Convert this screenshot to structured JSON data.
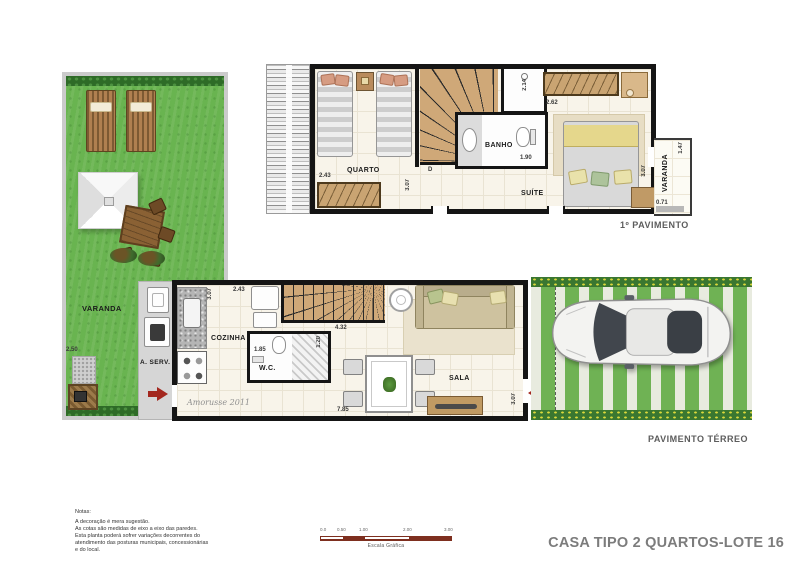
{
  "title": "CASA TIPO 2 QUARTOS-LOTE 16",
  "upper_floor": {
    "caption": "1º PAVIMENTO",
    "rooms": {
      "quarto": "QUARTO",
      "banho": "BANHO",
      "suite": "SUÍTE",
      "varanda": "VARANDA"
    },
    "dims": {
      "quarto_width": "2.43",
      "quarto_depth": "3.07",
      "shower_depth": "2.14",
      "banho_width": "1.90",
      "wardrobe_width": "2.62",
      "suite_depth": "3.07",
      "varanda_depth": "1.47",
      "varanda_width": "0.71"
    },
    "door_marker": "D"
  },
  "ground_floor": {
    "caption": "PAVIMENTO TÉRREO",
    "rooms": {
      "cozinha": "COZINHA",
      "wc": "W.C.",
      "sala": "SALA",
      "area_servico": "A. SERV.",
      "varanda": "VARANDA"
    },
    "dims": {
      "cozinha_depth": "3.07",
      "fridge_width": "2.43",
      "wc_width": "1.85",
      "wc_depth": "1.20",
      "stairs_width": "4.32",
      "sala_width": "7.85",
      "sala_depth": "3.07",
      "varanda_width": "2.50"
    },
    "signature": "Amorusse 2011"
  },
  "notes": {
    "heading": "Notas:",
    "lines": [
      "A decoração é mera sugestão.",
      "As cotas são medidas de eixo a eixo das paredes.",
      "Esta planta poderá sofrer variações decorrentes do",
      "atendimento das posturas municipais, concessionárias",
      "e do local."
    ]
  },
  "scale_bar": {
    "caption": "Escala Gráfica",
    "ticks": [
      "0.0",
      "0.50",
      "1.00",
      "2.00",
      "3.00"
    ]
  },
  "colors": {
    "wall": "#151515",
    "floor": "#f8f4ea",
    "grass": "#69b450",
    "wood": "#c9a472",
    "accent_red": "#a3271e",
    "title_gray": "#7c7c7c"
  }
}
